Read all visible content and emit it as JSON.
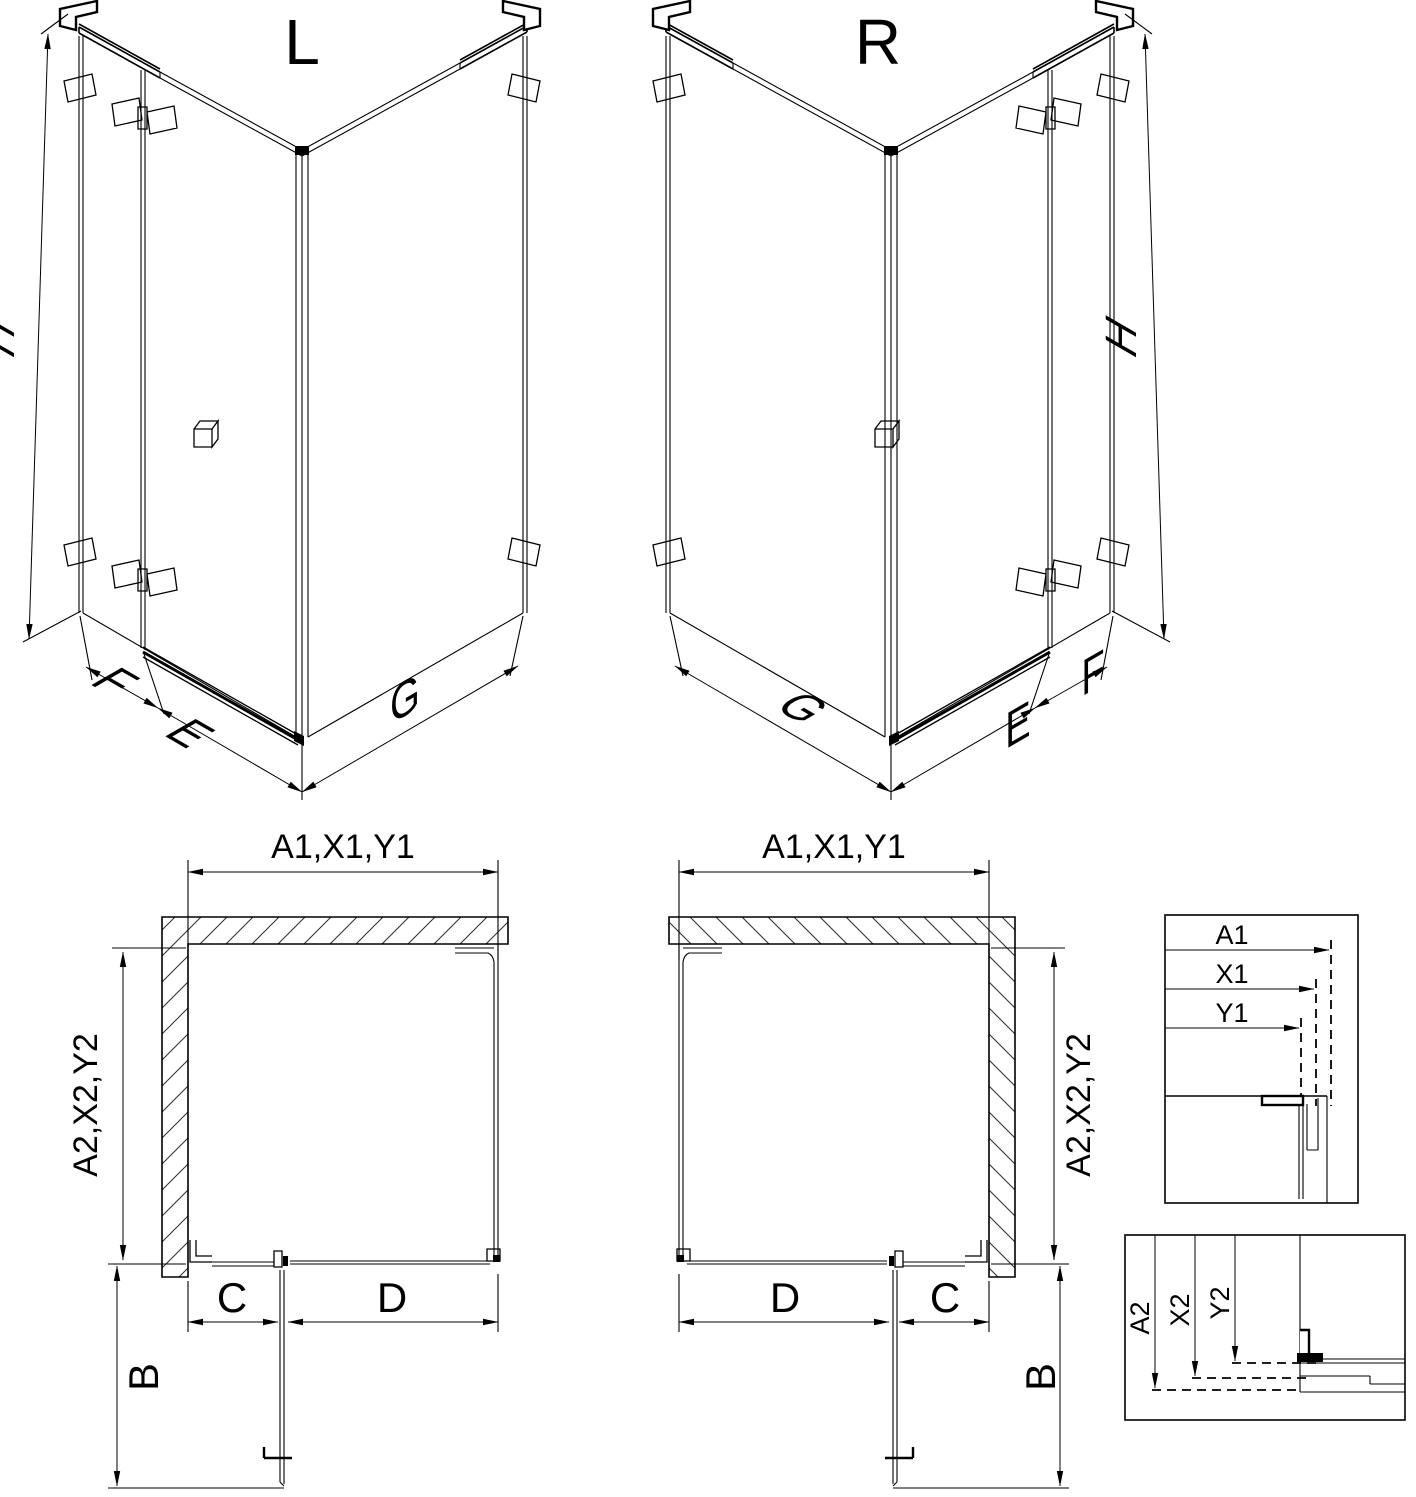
{
  "drawing": {
    "background": "#ffffff",
    "line_color": "#000000",
    "iso_left": {
      "title": "L",
      "dim_height": "H",
      "dim_side": "F",
      "dim_door": "E",
      "dim_return": "G"
    },
    "iso_right": {
      "title": "R",
      "dim_height": "H",
      "dim_side": "F",
      "dim_door": "E",
      "dim_return": "G"
    },
    "plan_left": {
      "dim_width": "A1,X1,Y1",
      "dim_depth": "A2,X2,Y2",
      "dim_fixed": "C",
      "dim_opening": "D",
      "dim_swing": "B"
    },
    "plan_right": {
      "dim_width": "A1,X1,Y1",
      "dim_depth": "A2,X2,Y2",
      "dim_fixed": "C",
      "dim_opening": "D",
      "dim_swing": "B"
    },
    "detail_width": {
      "labels": [
        "A1",
        "X1",
        "Y1"
      ]
    },
    "detail_depth": {
      "labels": [
        "A2",
        "X2",
        "Y2"
      ]
    }
  }
}
